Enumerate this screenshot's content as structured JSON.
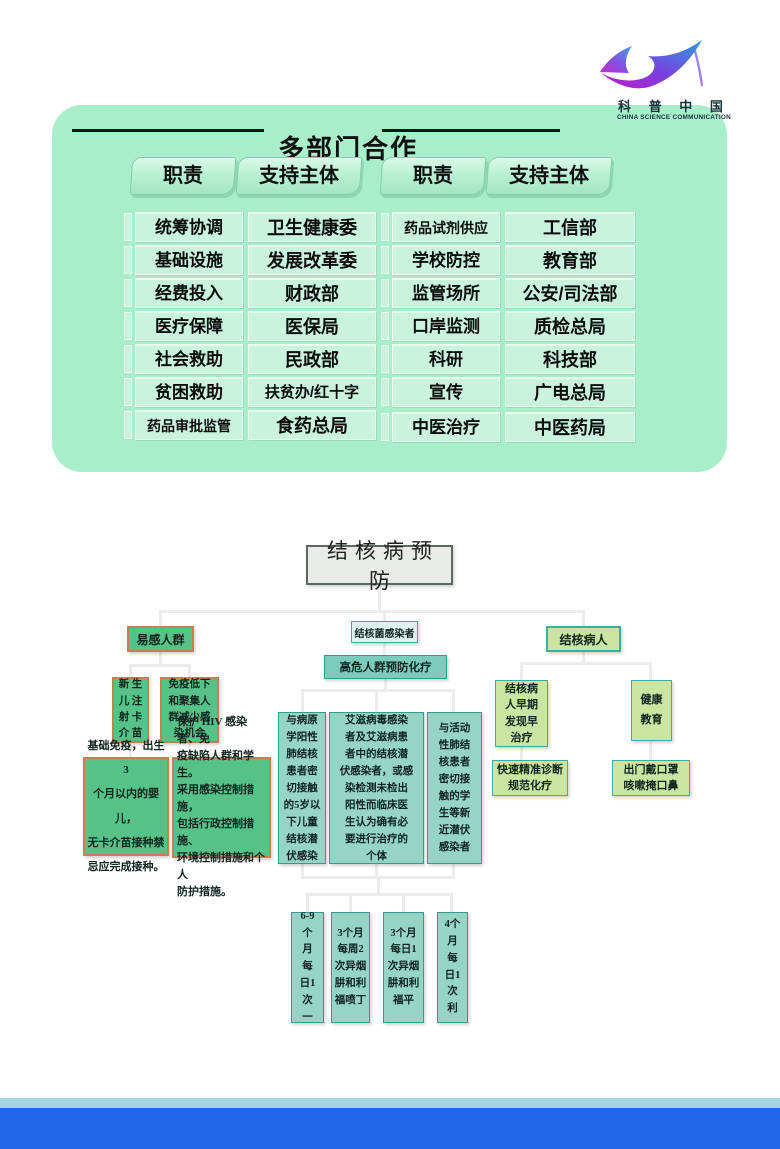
{
  "logo": {
    "name_cn": "科 普 中 国",
    "name_en": "CHINA SCIENCE COMMUNICATION"
  },
  "cooperation": {
    "title": "多部门合作",
    "headers": [
      "职责",
      "支持主体",
      "职责",
      "支持主体"
    ],
    "left_rows": [
      {
        "duty": "统筹协调",
        "supporter": "卫生健康委"
      },
      {
        "duty": "基础设施",
        "supporter": "发展改革委"
      },
      {
        "duty": "经费投入",
        "supporter": "财政部"
      },
      {
        "duty": "医疗保障",
        "supporter": "医保局"
      },
      {
        "duty": "社会救助",
        "supporter": "民政部"
      },
      {
        "duty": "贫困救助",
        "supporter": "扶贫办/红十字"
      },
      {
        "duty": "药品审批监管",
        "supporter": "食药总局"
      }
    ],
    "right_rows": [
      {
        "duty": "药品试剂供应",
        "supporter": "工信部"
      },
      {
        "duty": "学校防控",
        "supporter": "教育部"
      },
      {
        "duty": "监管场所",
        "supporter": "公安/司法部"
      },
      {
        "duty": "口岸监测",
        "supporter": "质检总局"
      },
      {
        "duty": "科研",
        "supporter": "科技部"
      },
      {
        "duty": "宣传",
        "supporter": "广电总局"
      },
      {
        "duty": "中医治疗",
        "supporter": "中医药局"
      }
    ]
  },
  "flowchart": {
    "root": "结核病预防",
    "susceptible": {
      "label": "易感人群",
      "measure1": "新 生\n儿 注\n射 卡\n介 苗",
      "measure2": "免疫低下\n和聚集人\n群减少感\n染机会",
      "detail1": "基础免疫，出生3\n个月以内的婴儿，\n无卡介苗接种禁\n忌应完成接种。",
      "detail2": "保护 HIV 感染者、免\n疫缺陷人群和学生。\n采用感染控制措施，\n包括行政控制措施、\n环境控制措施和个人\n防护措施。"
    },
    "infected": {
      "label": "结核菌感染者",
      "strategy": "高危人群预防化疗",
      "group1": "与病原\n学阳性\n肺结核\n患者密\n切接触\n的5岁以\n下儿童\n结核潜\n伏感染",
      "group2": "艾滋病毒感染\n者及艾滋病患\n者中的结核潜\n伏感染者，或感\n染检测未检出\n阳性而临床医\n生认为确有必\n要进行治疗的\n个体",
      "group3": "与活动\n性肺结\n核患者\n密切接\n触的学\n生等新\n近潜伏\n感染者",
      "regimen1": "6-9\n个\n月\n每\n日1\n次\n一",
      "regimen2": "3个月\n每周2\n次异烟\n肼和利\n福喷丁",
      "regimen3": "3个月\n每日1\n次异烟\n肼和利\n福平",
      "regimen4": "4个\n月\n每\n日1\n次\n利"
    },
    "patients": {
      "label": "结核病人",
      "measure1": "结核病\n人早期\n发现早\n治疗",
      "measure2": "健康\n教育",
      "detail1": "快速精准诊断\n规范化疗",
      "detail2": "出门戴口罩\n咳嗽掩口鼻"
    }
  },
  "colors": {
    "panel_bg": "#a9eecb",
    "cell_bg": "#c9f3dd",
    "tab_bg": "#b9f1d5",
    "green_fill": "#57c287",
    "orange_border": "#c87e53",
    "teal_fill": "#96d5c6",
    "teal_mid": "#7bccbb",
    "teal_light": "#def1ec",
    "teal_border": "#2f9e8e",
    "lime_fill": "#c9e59f",
    "root_fill": "#e8ece8",
    "connector": "#ececec",
    "footer_light": "#a8d5e4",
    "footer_blue": "#2166e7",
    "logo_gradient_start": "#c218c4",
    "logo_gradient_end": "#2e9bdf"
  }
}
